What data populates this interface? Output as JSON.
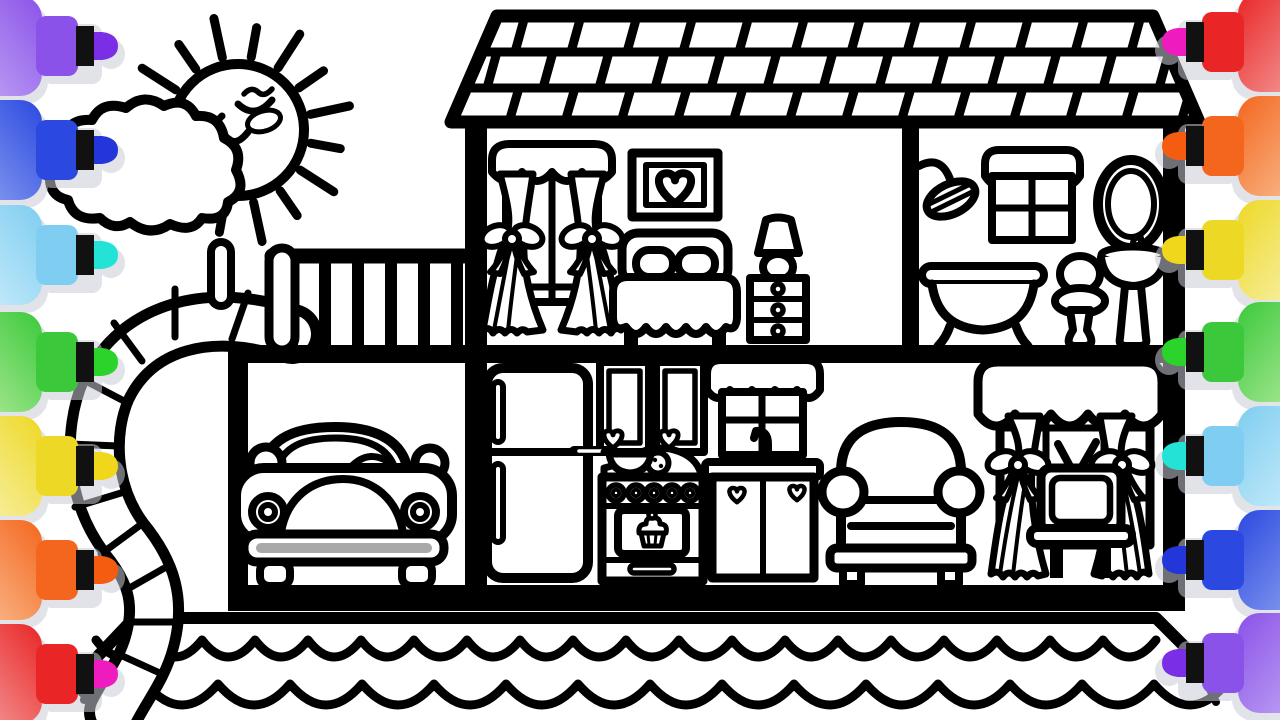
{
  "image": {
    "title": "Dollhouse coloring page with sun, cloud, slide, car and furnished rooms",
    "background": "#ffffff",
    "line_color": "#000000"
  },
  "palette": {
    "outline": "#000000",
    "background": "#ffffff",
    "bumper_stripe": "#a9a9a9",
    "blush_outline": "#c9c9c9",
    "marker_shadow": "#c9cdd6",
    "marker_collar": "#111111"
  },
  "markers": {
    "left": [
      {
        "name": "purple",
        "body": "#8a52e8",
        "body_light": "#c4a9f5",
        "tip": "#7a2fe6"
      },
      {
        "name": "blue",
        "body": "#2b49e0",
        "body_light": "#8fa3f0",
        "tip": "#2336d9"
      },
      {
        "name": "cyan",
        "body": "#7fcdf0",
        "body_light": "#cfeffc",
        "tip": "#23e2d6"
      },
      {
        "name": "green",
        "body": "#3bc93b",
        "body_light": "#b5eb9e",
        "tip": "#2bd32b"
      },
      {
        "name": "yellow",
        "body": "#eed826",
        "body_light": "#f8f3b5",
        "tip": "#f1d71c"
      },
      {
        "name": "orange",
        "body": "#f4661e",
        "body_light": "#f9c398",
        "tip": "#f55c10"
      },
      {
        "name": "red",
        "body": "#e92525",
        "body_light": "#f5a3a3",
        "tip": "#ee1cbf"
      }
    ],
    "right": [
      {
        "name": "red",
        "body": "#e92525",
        "body_light": "#f5a3a3",
        "tip": "#ee1cbf"
      },
      {
        "name": "orange",
        "body": "#f4661e",
        "body_light": "#f9c398",
        "tip": "#f55c10"
      },
      {
        "name": "yellow",
        "body": "#eed826",
        "body_light": "#f8f3b5",
        "tip": "#f1d71c"
      },
      {
        "name": "green",
        "body": "#3bc93b",
        "body_light": "#b5eb9e",
        "tip": "#2bd32b"
      },
      {
        "name": "cyan",
        "body": "#7fcdf0",
        "body_light": "#cfeffc",
        "tip": "#23e2d6"
      },
      {
        "name": "blue",
        "body": "#2b49e0",
        "body_light": "#8fa3f0",
        "tip": "#2336d9"
      },
      {
        "name": "purple",
        "body": "#8a52e8",
        "body_light": "#c4a9f5",
        "tip": "#7a2fe6"
      }
    ],
    "left_centers_y": [
      46,
      150,
      255,
      362,
      466,
      570,
      674
    ],
    "right_centers_y": [
      42,
      146,
      250,
      352,
      456,
      560,
      663
    ]
  },
  "sun": {
    "rays": 16
  },
  "railing": {
    "bars": 6
  }
}
